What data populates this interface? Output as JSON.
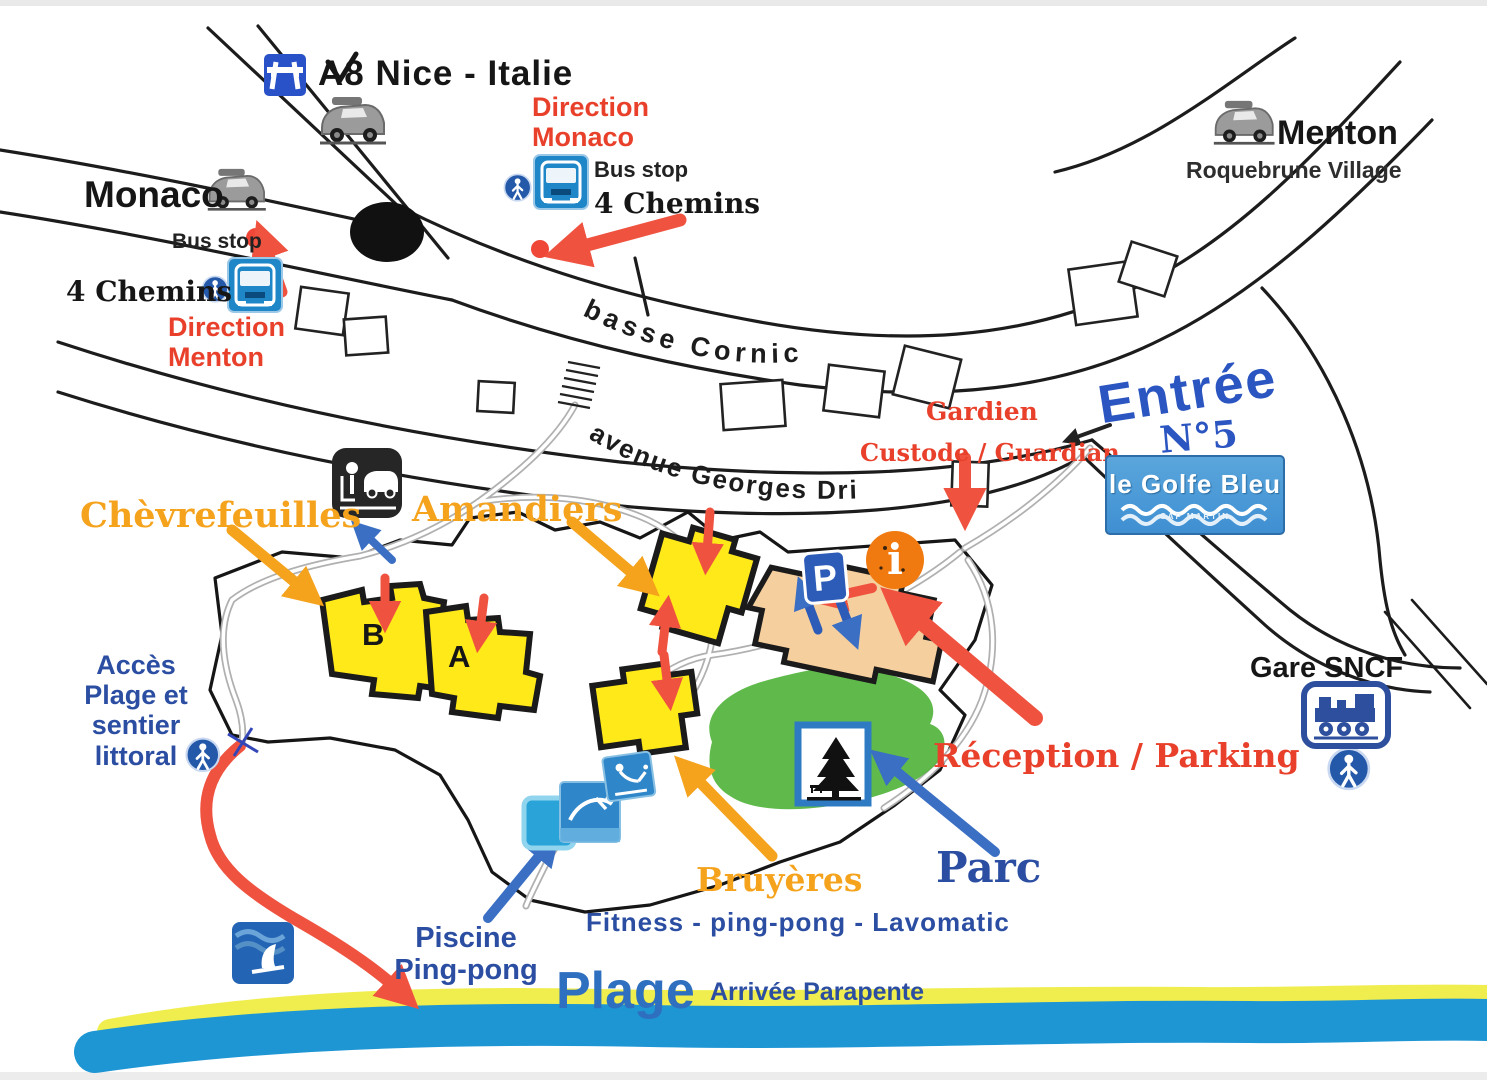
{
  "map_title": "Plan d'accès camping le Golfe Bleu",
  "colors": {
    "label_red": "#e8402a",
    "label_orange": "#f5a31d",
    "label_blue": "#2b4ea2",
    "building_yellow": "#ffe919",
    "reception_peach": "#f6cf9e",
    "park_green": "#52b43c",
    "sand_yellow": "#f0ee4e",
    "sea_blue": "#1f96d4"
  },
  "top": {
    "a8": "A8 Nice - Italie",
    "direction_monaco": "Direction\nMonaco",
    "bus_stop_top": "Bus stop",
    "four_chemins_top": "4 Chemins",
    "monaco": "Monaco",
    "bus_stop_left": "Bus stop",
    "four_chemins_left": "4 Chemins",
    "direction_menton": "Direction\nMenton",
    "menton": "Menton",
    "roquebrune": "Roquebrune Village"
  },
  "roads": {
    "basse_corniche": "basse   Corniche",
    "avenue_georges_drin": "avenue  Georges Drin"
  },
  "entrance": {
    "gardien": "Gardien",
    "custode_guardian": "Custode / Guardian",
    "entree": "Entrée",
    "entree_no": "N°5",
    "logo_name": "le Golfe Bleu",
    "logo_sub": "CAP MARTIN"
  },
  "site": {
    "chevrefeuilles": "Chèvrefeuilles",
    "amandiers": "Amandiers",
    "building_b": "B",
    "building_a": "A",
    "acces_plage": "Accès\nPlage et\nsentier\nlittoral",
    "reception_parking": "Réception / Parking",
    "parc": "Parc",
    "bruyeres": "Bruyères",
    "fitness": "Fitness - ping-pong - Lavomatic",
    "piscine": "Piscine\nPing-pong",
    "parking_letter": "P",
    "info_letter": "i"
  },
  "bottom": {
    "plage": "Plage",
    "arrivee_parapente": "Arrivée Parapente",
    "gare_sncf": "Gare SNCF"
  }
}
